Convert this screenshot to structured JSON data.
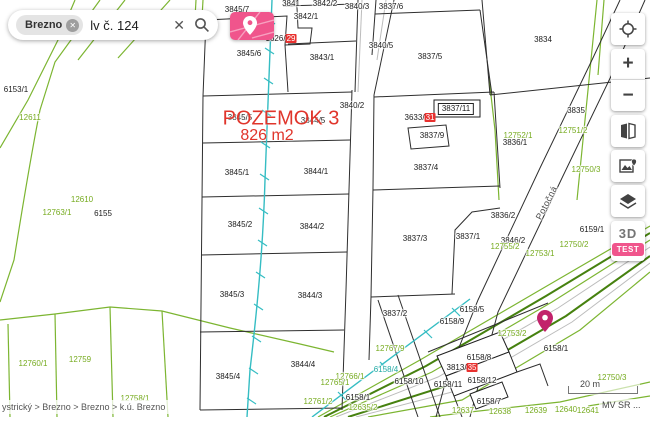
{
  "search": {
    "chip": "Brezno",
    "chip_remove_icon": "✕",
    "value": "lv č. 124",
    "clear_icon": "✕",
    "search_icon": "magnifier"
  },
  "marker_panel": {
    "icon": "map-pin"
  },
  "toolbar": {
    "locate_icon": "gps-crosshair",
    "zoom_in": "+",
    "zoom_out": "−",
    "compare_icon": "compare-maps",
    "basemap_icon": "basemap-image-pin",
    "layers_icon": "layers",
    "three_d": "3D",
    "test_badge": "TEST"
  },
  "selection": {
    "title": "POZEMOK 3",
    "area": "826 m2",
    "color": "#e0352b"
  },
  "map": {
    "marker_color": "#c2226b",
    "street": {
      "t": "Potočná",
      "x": 547,
      "y": 203,
      "k": "s",
      "rot": -63,
      "n": "street-label"
    },
    "labels": [
      {
        "t": "3845/7",
        "x": 237,
        "y": 10
      },
      {
        "t": "3841",
        "x": 291,
        "y": 4
      },
      {
        "t": "3842/2",
        "x": 325,
        "y": 4
      },
      {
        "t": "3840/3",
        "x": 357,
        "y": 7
      },
      {
        "t": "3837/6",
        "x": 391,
        "y": 7
      },
      {
        "t": "3842/1",
        "x": 306,
        "y": 17
      },
      {
        "t": "1626/",
        "hl": "29",
        "x": 281,
        "y": 39
      },
      {
        "t": "3845/6",
        "x": 249,
        "y": 54
      },
      {
        "t": "3843/1",
        "x": 322,
        "y": 58
      },
      {
        "t": "3840/5",
        "x": 381,
        "y": 46
      },
      {
        "t": "3834",
        "x": 543,
        "y": 40
      },
      {
        "t": "3837/5",
        "x": 430,
        "y": 57
      },
      {
        "t": "3840/2",
        "x": 352,
        "y": 106
      },
      {
        "t": "3837/11",
        "x": 456,
        "y": 109,
        "box": true
      },
      {
        "t": "3835",
        "x": 576,
        "y": 111
      },
      {
        "t": "3633/",
        "hl": "31",
        "x": 420,
        "y": 118
      },
      {
        "t": "3845/5",
        "x": 240,
        "y": 118
      },
      {
        "t": "3844/5",
        "x": 313,
        "y": 121
      },
      {
        "t": "3837/9",
        "x": 432,
        "y": 136
      },
      {
        "t": "12752/1",
        "x": 518,
        "y": 136,
        "k": "g"
      },
      {
        "t": "12751/2",
        "x": 573,
        "y": 131,
        "k": "g"
      },
      {
        "t": "3836/1",
        "x": 515,
        "y": 143
      },
      {
        "t": "12611",
        "x": 30,
        "y": 118,
        "k": "g"
      },
      {
        "t": "12750/3",
        "x": 586,
        "y": 170,
        "k": "g"
      },
      {
        "t": "3837/4",
        "x": 426,
        "y": 168
      },
      {
        "t": "3845/1",
        "x": 237,
        "y": 173
      },
      {
        "t": "3844/1",
        "x": 316,
        "y": 172
      },
      {
        "t": "12610",
        "x": 82,
        "y": 200,
        "k": "g"
      },
      {
        "t": "6155",
        "x": 103,
        "y": 214
      },
      {
        "t": "12763/1",
        "x": 57,
        "y": 213,
        "k": "g"
      },
      {
        "t": "3836/2",
        "x": 503,
        "y": 216
      },
      {
        "t": "3845/2",
        "x": 240,
        "y": 225
      },
      {
        "t": "3844/2",
        "x": 312,
        "y": 227
      },
      {
        "t": "6159/1",
        "x": 592,
        "y": 230
      },
      {
        "t": "3837/3",
        "x": 415,
        "y": 239
      },
      {
        "t": "3837/1",
        "x": 468,
        "y": 237
      },
      {
        "t": "3846/2",
        "x": 513,
        "y": 241
      },
      {
        "t": "12755/2",
        "x": 505,
        "y": 247,
        "k": "g"
      },
      {
        "t": "12753/1",
        "x": 540,
        "y": 254,
        "k": "g"
      },
      {
        "t": "12750/2",
        "x": 574,
        "y": 245,
        "k": "g"
      },
      {
        "t": "6153/1",
        "x": 16,
        "y": 90
      },
      {
        "t": "3845/3",
        "x": 232,
        "y": 295
      },
      {
        "t": "3844/3",
        "x": 310,
        "y": 296
      },
      {
        "t": "3837/2",
        "x": 395,
        "y": 314
      },
      {
        "t": "6158/5",
        "x": 472,
        "y": 310
      },
      {
        "t": "6158/9",
        "x": 452,
        "y": 322
      },
      {
        "t": "12753/2",
        "x": 512,
        "y": 334,
        "k": "g"
      },
      {
        "t": "6158/8",
        "x": 479,
        "y": 358
      },
      {
        "t": "3813/",
        "hl": "35",
        "x": 462,
        "y": 368
      },
      {
        "t": "6158/1",
        "x": 556,
        "y": 349
      },
      {
        "t": "12767/9",
        "x": 390,
        "y": 349,
        "k": "g"
      },
      {
        "t": "3844/4",
        "x": 303,
        "y": 365
      },
      {
        "t": "3845/4",
        "x": 228,
        "y": 377
      },
      {
        "t": "12760/1",
        "x": 33,
        "y": 364,
        "k": "g"
      },
      {
        "t": "12759",
        "x": 80,
        "y": 360,
        "k": "g"
      },
      {
        "t": "6158/4",
        "x": 386,
        "y": 370,
        "k": "t"
      },
      {
        "t": "12766/1",
        "x": 350,
        "y": 377,
        "k": "g"
      },
      {
        "t": "12765/1",
        "x": 335,
        "y": 383,
        "k": "g"
      },
      {
        "t": "6158/10",
        "x": 409,
        "y": 382
      },
      {
        "t": "6158/12",
        "x": 482,
        "y": 381
      },
      {
        "t": "6158/11",
        "x": 448,
        "y": 385
      },
      {
        "t": "6158/1",
        "x": 358,
        "y": 398
      },
      {
        "t": "12761/2",
        "x": 318,
        "y": 402,
        "k": "g"
      },
      {
        "t": "12758/1",
        "x": 135,
        "y": 399,
        "k": "g"
      },
      {
        "t": "12635/2",
        "x": 363,
        "y": 408,
        "k": "g"
      },
      {
        "t": "6158/7",
        "x": 489,
        "y": 402
      },
      {
        "t": "12637",
        "x": 463,
        "y": 411,
        "k": "g"
      },
      {
        "t": "12638",
        "x": 500,
        "y": 412,
        "k": "g"
      },
      {
        "t": "12639",
        "x": 536,
        "y": 411,
        "k": "g"
      },
      {
        "t": "12640",
        "x": 566,
        "y": 410,
        "k": "g"
      },
      {
        "t": "12641",
        "x": 588,
        "y": 411,
        "k": "g"
      },
      {
        "t": "12750/3",
        "x": 612,
        "y": 378,
        "k": "g"
      }
    ]
  },
  "footer": {
    "breadcrumb": "ystrický > Brezno > Brezno > k.ú. Brezno",
    "scale": "20 m",
    "attribution": "MV SR ..."
  },
  "colors": {
    "accent_pink": "#f0558c",
    "highlight_red": "#e8312f",
    "parcel_green": "#7cb531",
    "stream_teal": "#35bdc3"
  }
}
